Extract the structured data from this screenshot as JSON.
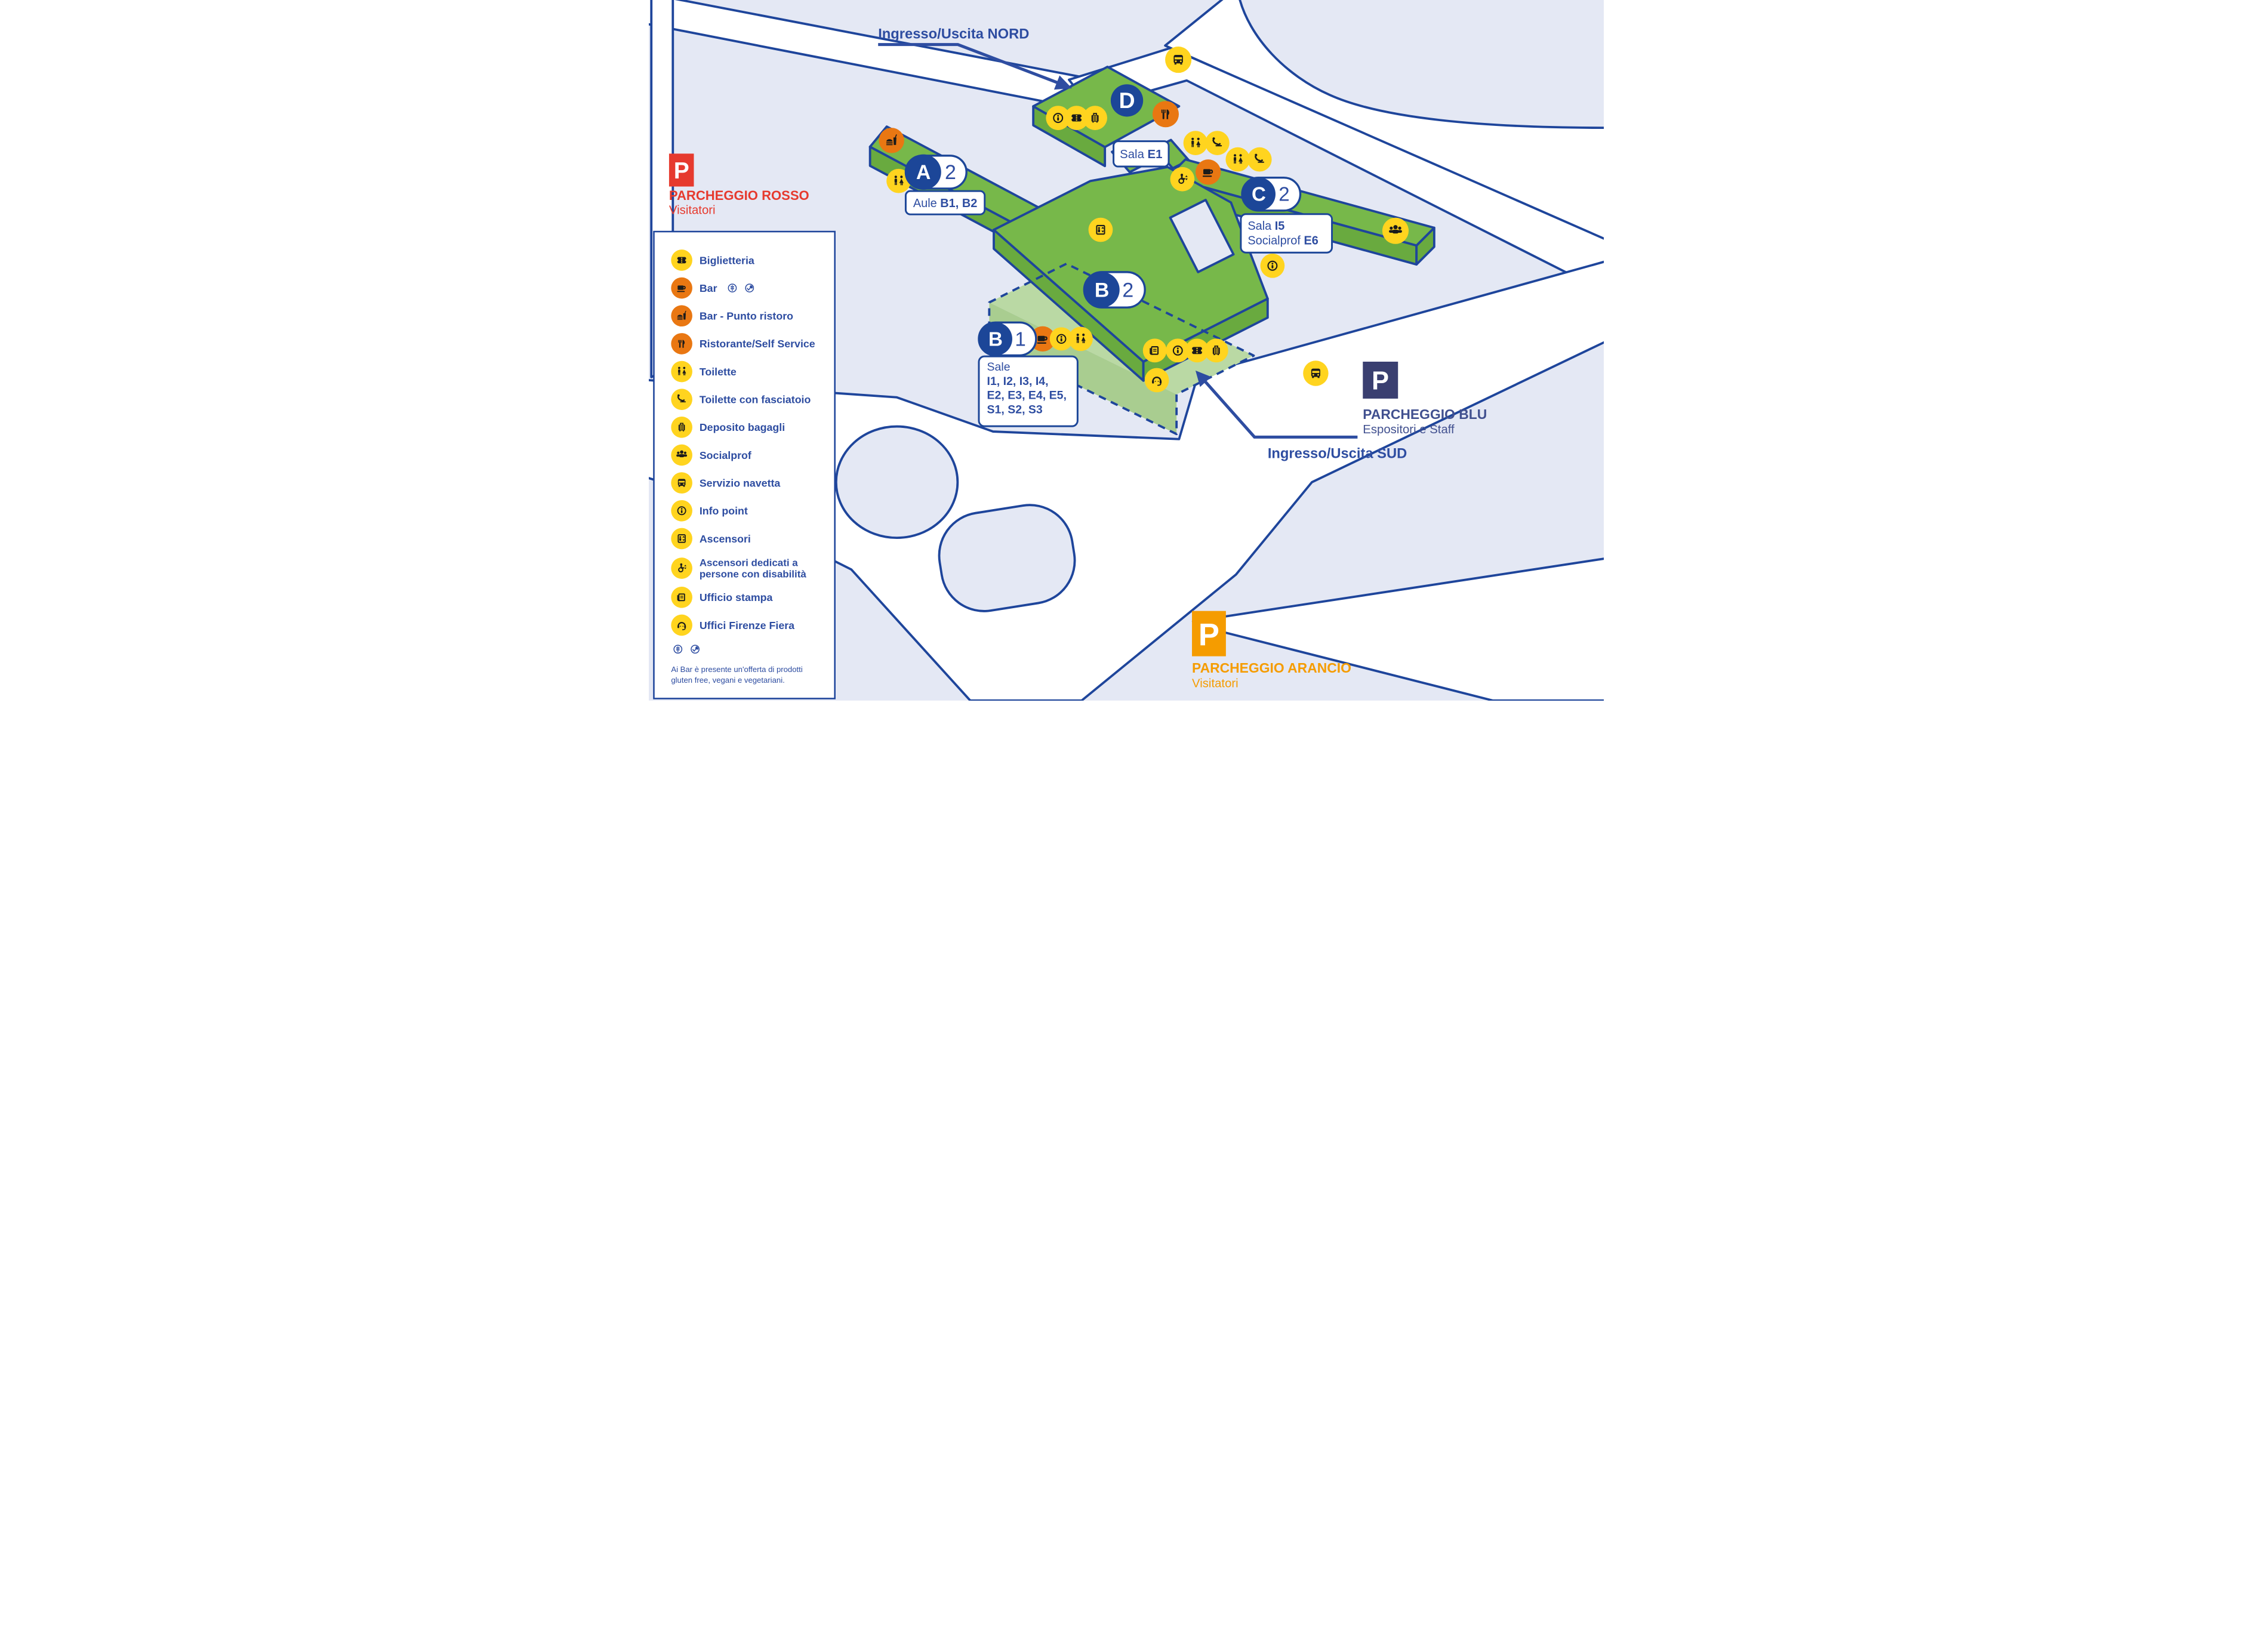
{
  "colors": {
    "navy_line": "#1e459b",
    "text_navy": "#2e4da1",
    "lavender": "#e4e8f4",
    "road_white": "#ffffff",
    "green_top": "#77b84a",
    "green_side": "#69aa3f",
    "green_dashed": "#bad9a4",
    "icon_yellow": "#ffd41f",
    "icon_orange": "#e97712",
    "red": "#e63a2e",
    "blu_square": "#3a3f70",
    "arancio": "#f59c00"
  },
  "entrances": {
    "north": "Ingresso/Uscita NORD",
    "south": "Ingresso/Uscita SUD"
  },
  "parking": {
    "rosso": {
      "p": "P",
      "name": "PARCHEGGIO ROSSO",
      "sub": "Visitatori"
    },
    "blu": {
      "p": "P",
      "name": "PARCHEGGIO BLU",
      "sub": "Espositori e Staff"
    },
    "arancio": {
      "p": "P",
      "name": "PARCHEGGIO ARANCIO",
      "sub": "Visitatori"
    }
  },
  "buildings": {
    "a": {
      "letter": "A",
      "level": "2",
      "label_prefix": "Aule ",
      "label_bold": "B1, B2"
    },
    "b_upper": {
      "letter": "B",
      "level": "2"
    },
    "b_lower": {
      "letter": "B",
      "level": "1",
      "box_title": "Sale",
      "box_line1": "I1, I2, I3, I4,",
      "box_line2": "E2, E3, E4, E5,",
      "box_line3": "S1, S2, S3"
    },
    "c": {
      "letter": "C",
      "level": "2",
      "box_line1_prefix": "Sala ",
      "box_line1_bold": "I5",
      "box_line2_prefix": "Socialprof ",
      "box_line2_bold": "E6"
    },
    "d": {
      "letter": "D",
      "box_prefix": "Sala ",
      "box_bold": "E1"
    }
  },
  "legend": {
    "items": [
      {
        "icon": "ticket-icon",
        "label": "Biglietteria"
      },
      {
        "icon": "coffee-icon",
        "label": "Bar",
        "badges": [
          "gluten-free-icon",
          "vegan-icon"
        ]
      },
      {
        "icon": "snack-icon",
        "label": "Bar - Punto ristoro"
      },
      {
        "icon": "restaurant-icon",
        "label": "Ristorante/Self Service"
      },
      {
        "icon": "toilets-icon",
        "label": "Toilette"
      },
      {
        "icon": "baby-change-icon",
        "label": "Toilette con fasciatoio"
      },
      {
        "icon": "luggage-icon",
        "label": "Deposito bagagli"
      },
      {
        "icon": "people-icon",
        "label": "Socialprof"
      },
      {
        "icon": "bus-icon",
        "label": "Servizio navetta"
      },
      {
        "icon": "info-icon",
        "label": "Info point"
      },
      {
        "icon": "elevator-icon",
        "label": "Ascensori"
      },
      {
        "icon": "accessible-elevator-icon",
        "label": "Ascensori dedicati a",
        "label2": "persone con disabilità"
      },
      {
        "icon": "press-icon",
        "label": "Ufficio stampa"
      },
      {
        "icon": "headset-icon",
        "label": "Uffici Firenze Fiera"
      }
    ],
    "footnote1": "Ai Bar è presente un'offerta di prodotti",
    "footnote2": "gluten free, vegani e vegetariani."
  },
  "icons": {
    "ticket-icon": "ticket",
    "coffee-icon": "coffee cup",
    "snack-icon": "burger and drink",
    "restaurant-icon": "fork and knife",
    "toilets-icon": "man and woman",
    "baby-change-icon": "baby changing table",
    "luggage-icon": "suitcase",
    "people-icon": "group of people",
    "bus-icon": "shuttle bus",
    "info-icon": "information",
    "elevator-icon": "elevator",
    "accessible-elevator-icon": "wheelchair elevator",
    "press-icon": "newspaper",
    "headset-icon": "support operator headset",
    "gluten-free-icon": "wheat in circle",
    "vegan-icon": "leaf with check in circle"
  }
}
